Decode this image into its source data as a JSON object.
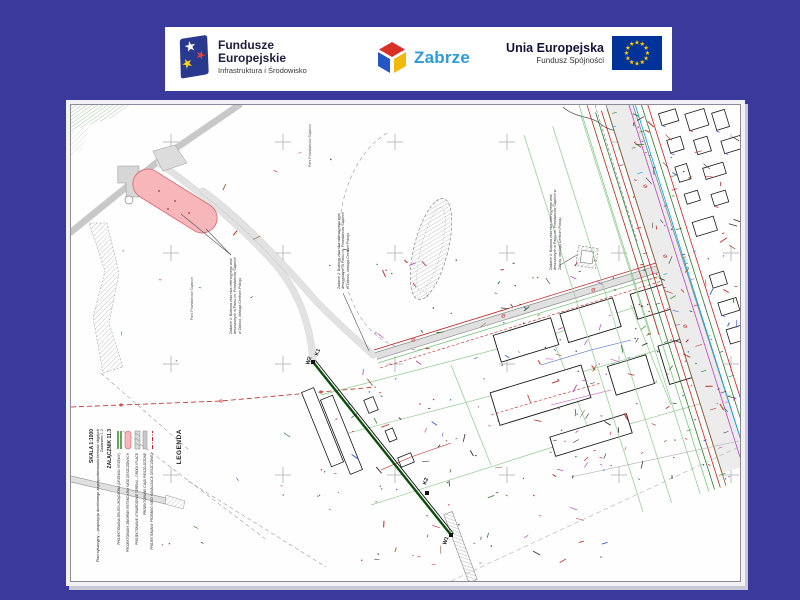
{
  "banner": {
    "fundusze_logo": {
      "line1": "Fundusze",
      "line2": "Europejskie",
      "subtitle": "Infrastruktura i Środowisko"
    },
    "zabrze_logo": {
      "name": "Zabrze"
    },
    "eu_logo": {
      "line1": "Unia Europejska",
      "line2": "Fundusz Spójności"
    }
  },
  "map": {
    "point_labels": {
      "k1": "K1",
      "w2": "W2",
      "k2": "K2",
      "w1": "W1"
    },
    "area_labels": {
      "park_top": "Park Powstańców Śląskich",
      "park_left": "Park Powstańców Śląskich"
    },
    "annotations": {
      "a1": "Zadanie 2: Budowa zbiornika retencyjnego wód deszczowych w Parku im. Powstańców Śląskich w Zabrzu, obsługa Centrum Pokoju",
      "a2": "Zadanie 2: Budowa zbiornika retencyjnego wód deszczowych w Parku im. Powstańców Śląskich w Zabrzu, obsługa Centrum Pokoju",
      "a3": "Zadanie 2: Budowa zbiornika retencyjnego wód deszczowych w Parku im. Powstańców Śląskich w Zabrzu, obsługa Centrum Pokoju"
    },
    "marker_symbol": "Ø",
    "legend": {
      "title": "LEGENDA",
      "items": [
        {
          "symbol": "green-lines",
          "label": "PROJEKTOWANA ZIELEŃ URZĄDZONA (DRZEWA I KRZEWY)"
        },
        {
          "symbol": "pink-oval",
          "label": "PROJEKTOWANY ZBIORNIK RETENCYJNY WÓD DESZCZOWYCH"
        },
        {
          "symbol": "gray-hatch",
          "label": "PROJEKTOWANE UTWARDZENIE TERENU – DROGI I PLACE"
        },
        {
          "symbol": "gray-bar",
          "label": "PROJEKTOWANE CIĄGI PIESZO-JEZDNE"
        },
        {
          "symbol": "red-line",
          "label": "PROJEKTOWANY PRZEBIEG SIECI KANALIZACJI DESZCZOWEJ"
        }
      ],
      "attachment": "ZAŁĄCZNIK 11.3",
      "description": "Plan sytuacyjny – propozycja docelowego zagospodarowania terenów objętych Zadaniem 1.2",
      "scale": "SKALA 1:1000"
    }
  },
  "colors": {
    "slide_background": "#3a3a9d",
    "banner_background": "#ffffff",
    "fe_logo_navy": "#28398e",
    "fe_star_white": "#ffffff",
    "fe_star_yellow": "#ffd51e",
    "fe_star_red": "#e8413c",
    "zabrze_red": "#d93025",
    "zabrze_blue": "#2456c5",
    "zabrze_yellow": "#f2b90c",
    "zabrze_text": "#2d9bd5",
    "eu_flag_blue": "#003399",
    "eu_star_yellow": "#ffcc00",
    "pink_zone": "#f6b6ba",
    "pink_zone_edge": "#d2666e",
    "road_fill": "#e2e2e2",
    "road_edge": "#979797",
    "pipe_green": "#0b4d0b",
    "utility_red": "#c22222",
    "utility_green": "#2b7a2b",
    "utility_lightgreen": "#7cc47c",
    "utility_cyan": "#00a0e0",
    "utility_magenta": "#bb44bb",
    "utility_brown": "#8a5a2a",
    "grid_cross": "#b8b8c0"
  }
}
